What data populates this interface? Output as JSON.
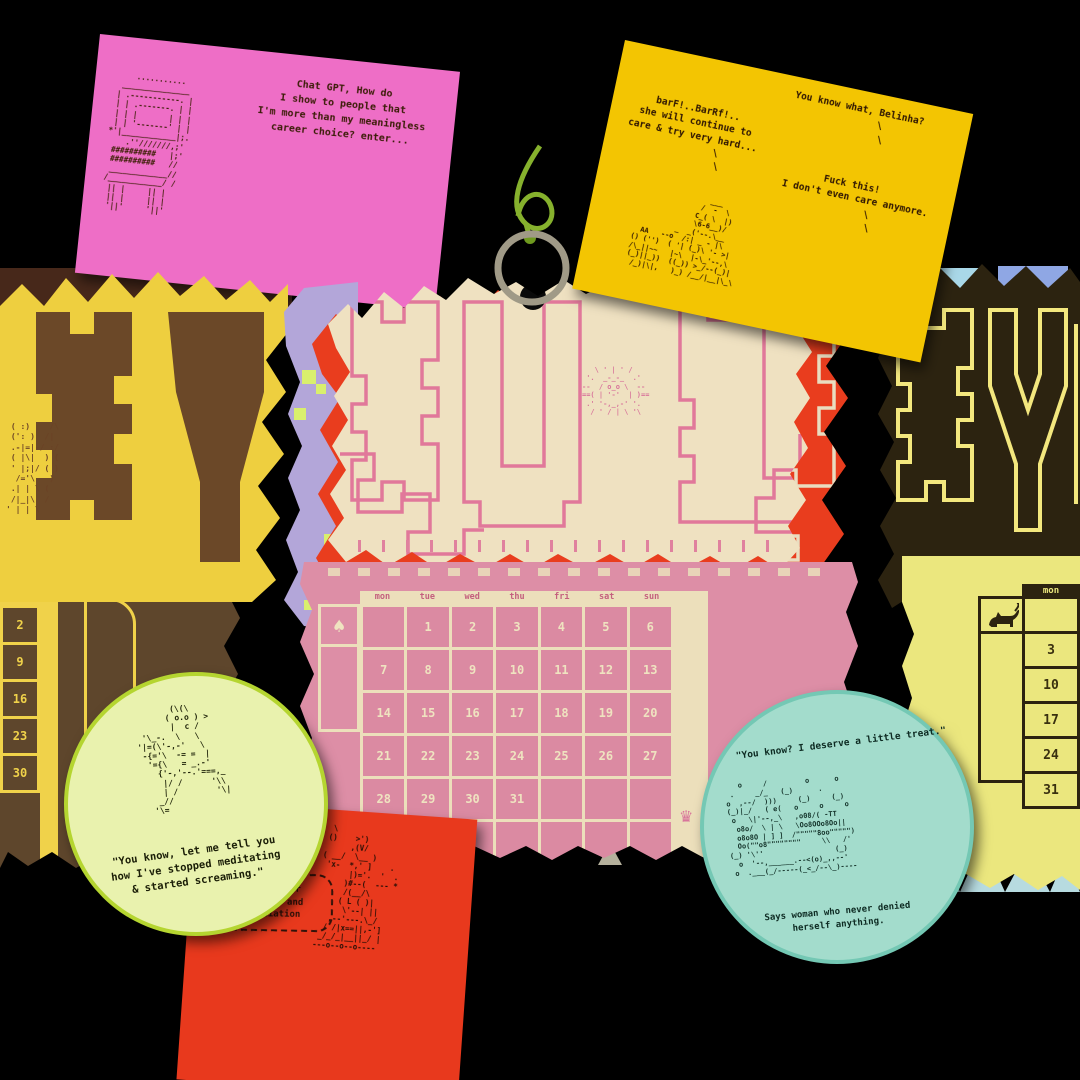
{
  "notes": {
    "pink": {
      "message": "Chat GPT, How do\nI show to people that\nI'm more than my meaningless\ncareer choice? enter...",
      "ascii_art": "      ...........\n   _______________\n  | .-----------. |\n  | | .-------. | |\n  | | |       | | |\n  | | '-------' | |\n *'|____________|;.\n     .''///////,;'\n  ##########   |;'\n  ##########   //\n  _____________//\n /____________/ /\n  || |     || |\n  || |     || |\n  '||'     '||'"
    },
    "yellow": {
      "caption_top": "You know what, Belinha?\n        \\\n         \\",
      "caption_left": "barF!..BarRf!..\nshe will continue to\ncare & try very hard...\n         \\\n          \\",
      "caption_right": "Fuck this!\n  I don't even care anymore.\n       \\\n        \\",
      "ascii_art": "                 ___\n               /  -  \\\n              C_( \\  |)\n              \\6-6__)/\n          _  _('--.\\__\n  AA   --o  /:| _ - |\\\n() ('')  ( '| (_)\\ '- >|\n/\\_||~~   |~\\  |-\\_'--,\\\n(_)||_))  ((_)) >_/--(_)|\n /_)|\\|,   )_) /__/|__|\\_\\"
    },
    "green": {
      "ascii_art": "       (\\(\\\n      ( o.o ) >\n       |  c /\n '\\_-.  \\   \\\n'|=(\\'-,-'   \\\n -{='\\  -= =  |\n  '={\\   = _.-'\n    {'-,'--.'===,_\n     |/ /      '\\\\\n     | /        '\\|\n    _//\n   '\\=",
      "quote": "\"You know, let me tell you\nhow I've stopped meditating\n& started screaming.\""
    },
    "red": {
      "speech_bubble": "yay! my year\nof stress and\ndissociation",
      "ascii_art": "   \\\n  ()    >')\n       ,(V/\n ( __/  \\__ )\n  'x-  *,' ]    .\n       |)='.  '  .\n      )#--(  --- *\n      /(__/\\\n     ( L ( )|\n      \\'--| ||\n   ,--'---.\\_/\n  / /|x==||,-']\n _/_/_|__||_/ |\n---o--o--o----"
    },
    "teal": {
      "caption_top": "\"You know? I deserve a little treat.\"",
      "ascii_art": "   o     /         o      o\n .     _/_   (_)      .\no  ,--/  )))     (_)     (_)\n(_)|_/   ( e(   o     o     o\n o   \\|'--,_\\   ,o08/( -TT\n  o8o/  \\ | \\   \\Oo8OOo8Oo||\n  o8o8O | ] ]  /\"\"\"\"\"8oo\"\"\"\"\")\n  Oo(\"\"o8\"\"\"\"\"\"\"\"     \\\\   /'\n(_) '\\''                 (_)\n  o  '--,______.--<(o)_,,--'\n o  .___(_/-----(_<_/--\\_)----",
      "caption_bottom": "Says woman who never denied\nherself anything."
    }
  },
  "calendar": {
    "month": "JUL",
    "sun_ascii": "   \\ ' | ' /\n '.  _-_-_  .'\n--  / o_o \\  --\n==( | '-'  | )==\n .' '-,_,-' '.\n  / ' / | \\ '\\",
    "day_headers": [
      "mon",
      "tue",
      "wed",
      "thu",
      "fri",
      "sat",
      "sun"
    ],
    "weeks": [
      [
        "",
        "1",
        "2",
        "3",
        "4",
        "5",
        "6"
      ],
      [
        "7",
        "8",
        "9",
        "10",
        "11",
        "12",
        "13"
      ],
      [
        "14",
        "15",
        "16",
        "17",
        "18",
        "19",
        "20"
      ],
      [
        "21",
        "22",
        "23",
        "24",
        "25",
        "26",
        "27"
      ],
      [
        "28",
        "29",
        "30",
        "31",
        "",
        "",
        ""
      ],
      [
        "",
        "",
        "",
        "",
        "",
        "",
        ""
      ]
    ],
    "spade": "♠",
    "crown": "♛"
  },
  "left_page": {
    "day_header": "sun",
    "dates": [
      "2",
      "9",
      "16",
      "23",
      "30"
    ],
    "ascii_art": " ( :)    /\\\n (': )  /|\n .-|=|-/ :/\n ( |\\|  ) (\n ' |;|/ ( )\n  /='\\   )\n .| | \\ (\n /|_|\\  /\n' | | \\"
  },
  "right_page": {
    "day_header": "mon",
    "dates": [
      "",
      "3",
      "10",
      "17",
      "24",
      "31"
    ]
  }
}
